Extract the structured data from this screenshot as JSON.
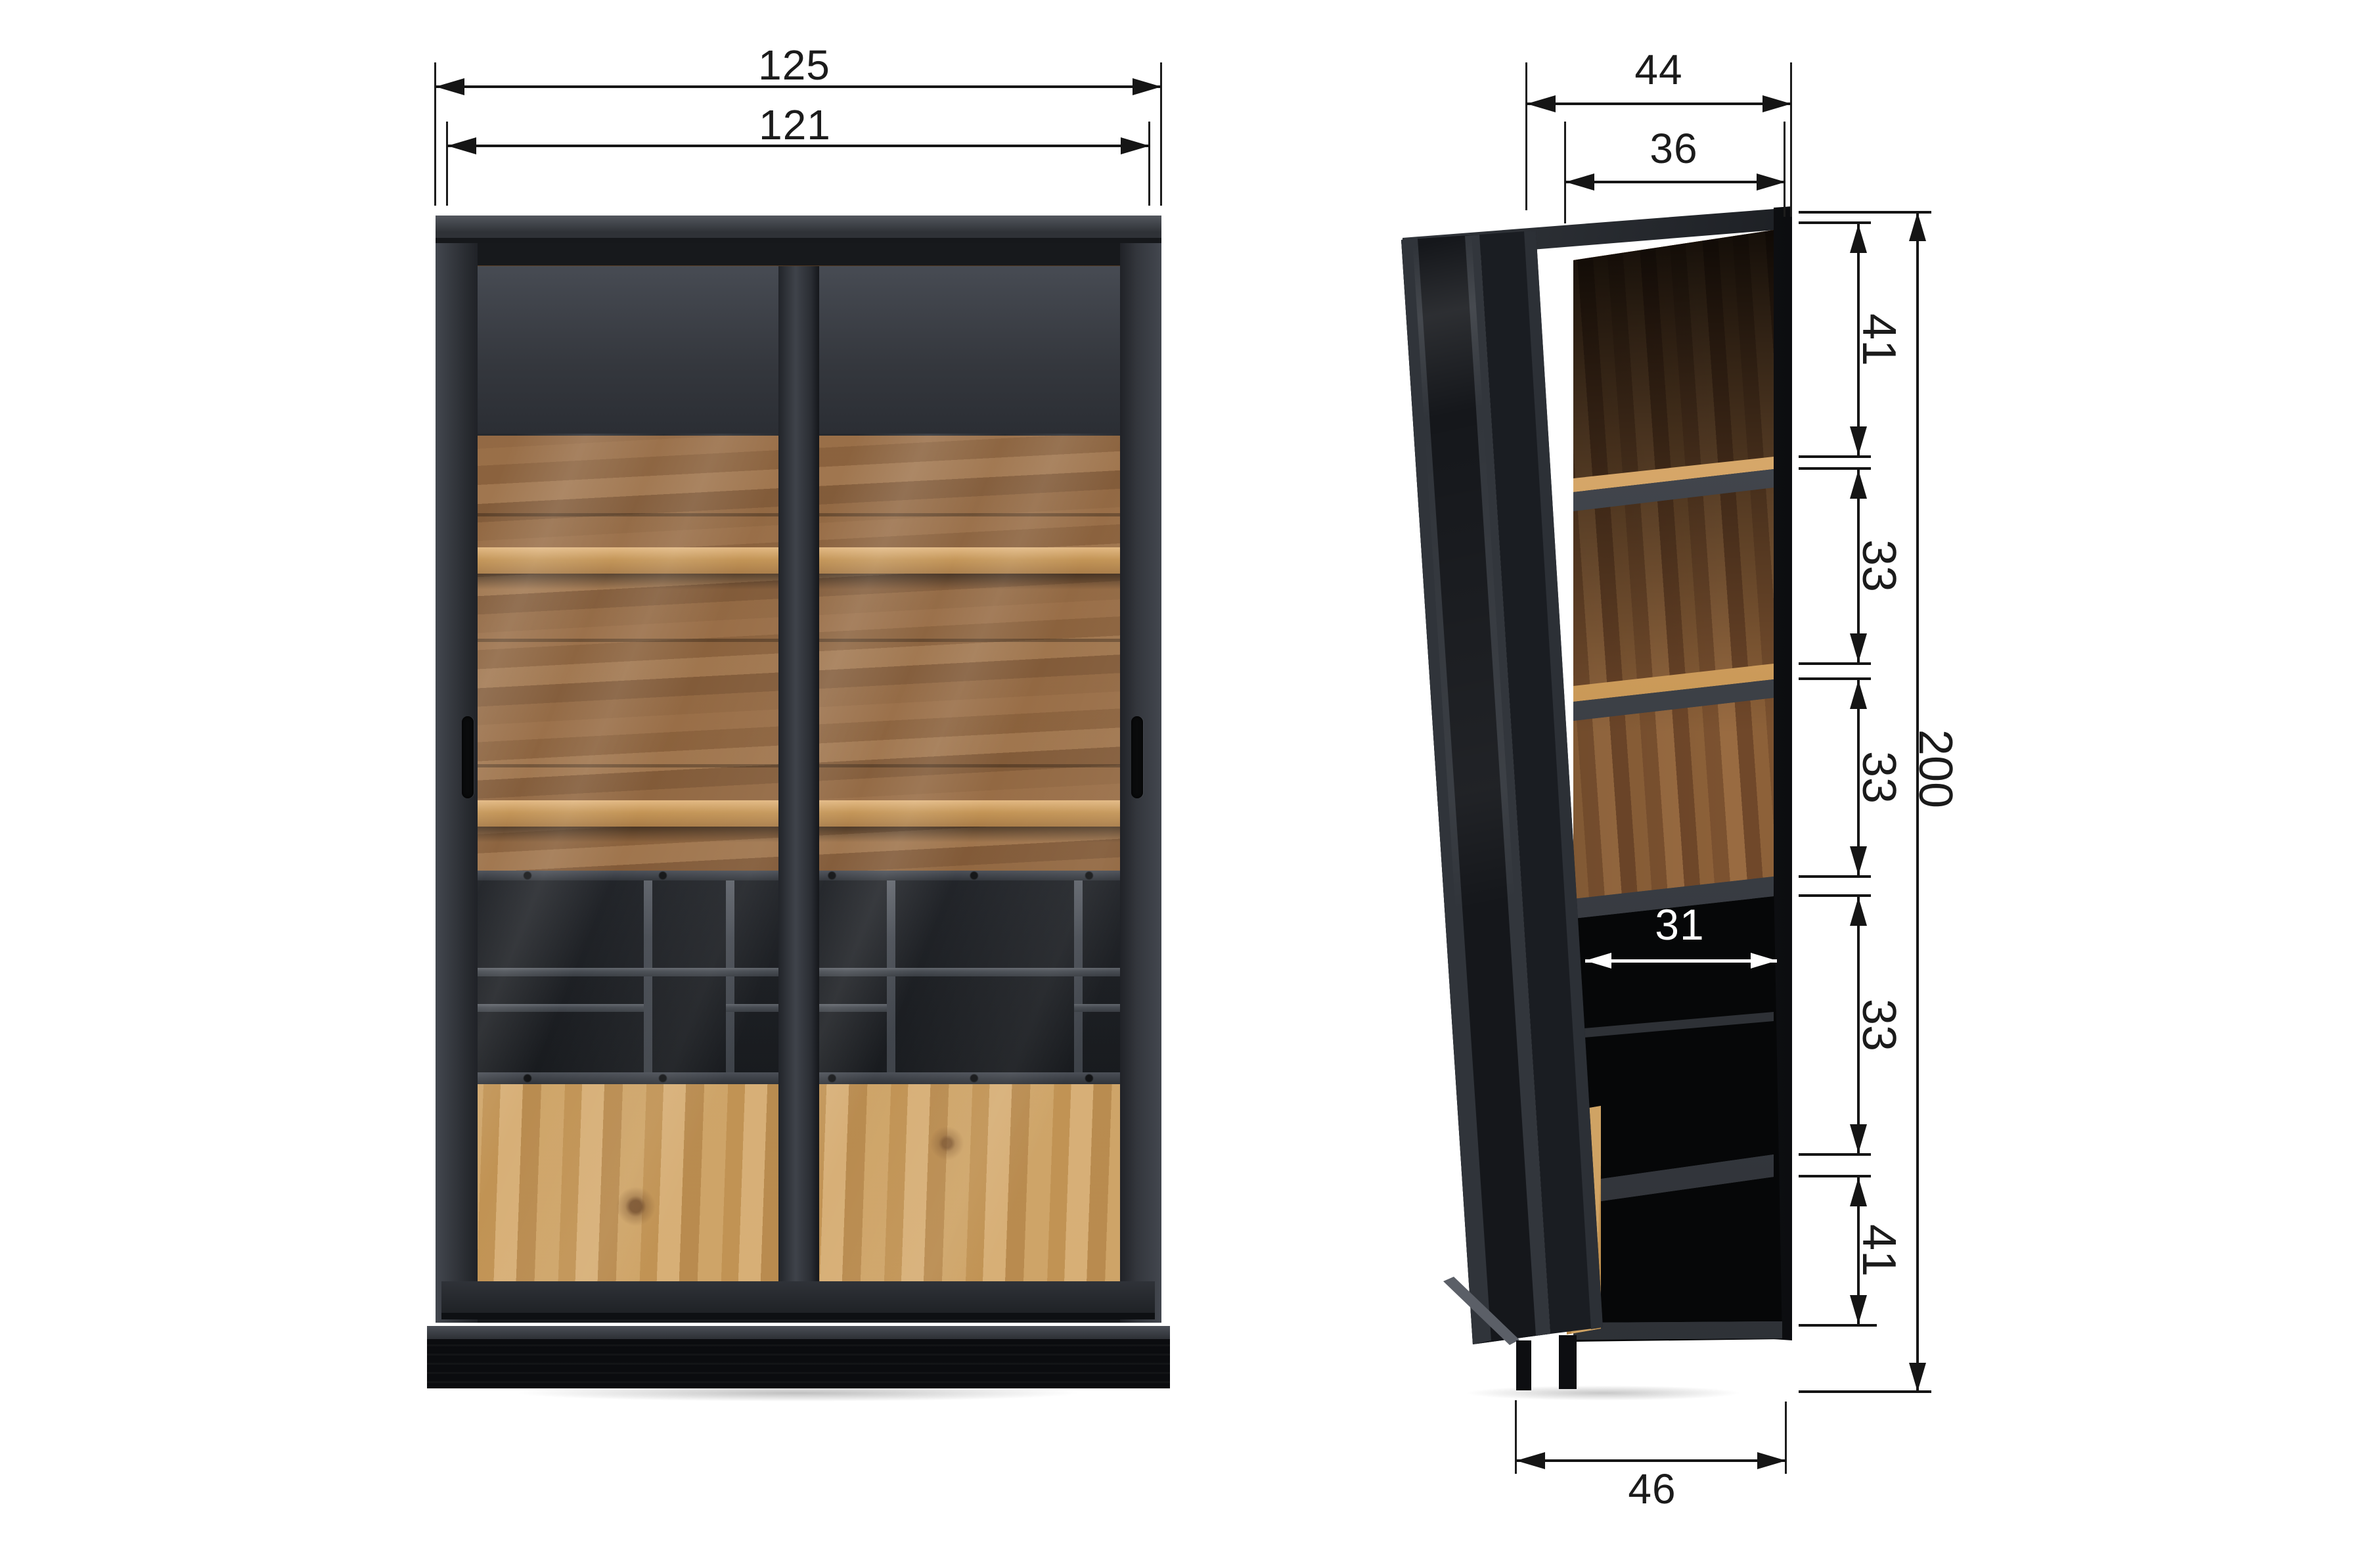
{
  "palette": {
    "line": "#161616",
    "cabinet_black": "#0d0e11",
    "frame_gray": "#3c4046",
    "wood_dark": "#8a5f38",
    "wood_light": "#c99a5e",
    "dim_white": "#ffffff"
  },
  "front_view": {
    "overall_width": "125",
    "inner_width": "121"
  },
  "side_view": {
    "overall_depth": "44",
    "inner_depth": "36",
    "overall_height": "200",
    "shelf_inner_depth": "31",
    "base_depth": "46",
    "height_segments": [
      {
        "label": "41"
      },
      {
        "label": "33"
      },
      {
        "label": "33"
      },
      {
        "label": "33"
      },
      {
        "label": "41"
      }
    ]
  }
}
